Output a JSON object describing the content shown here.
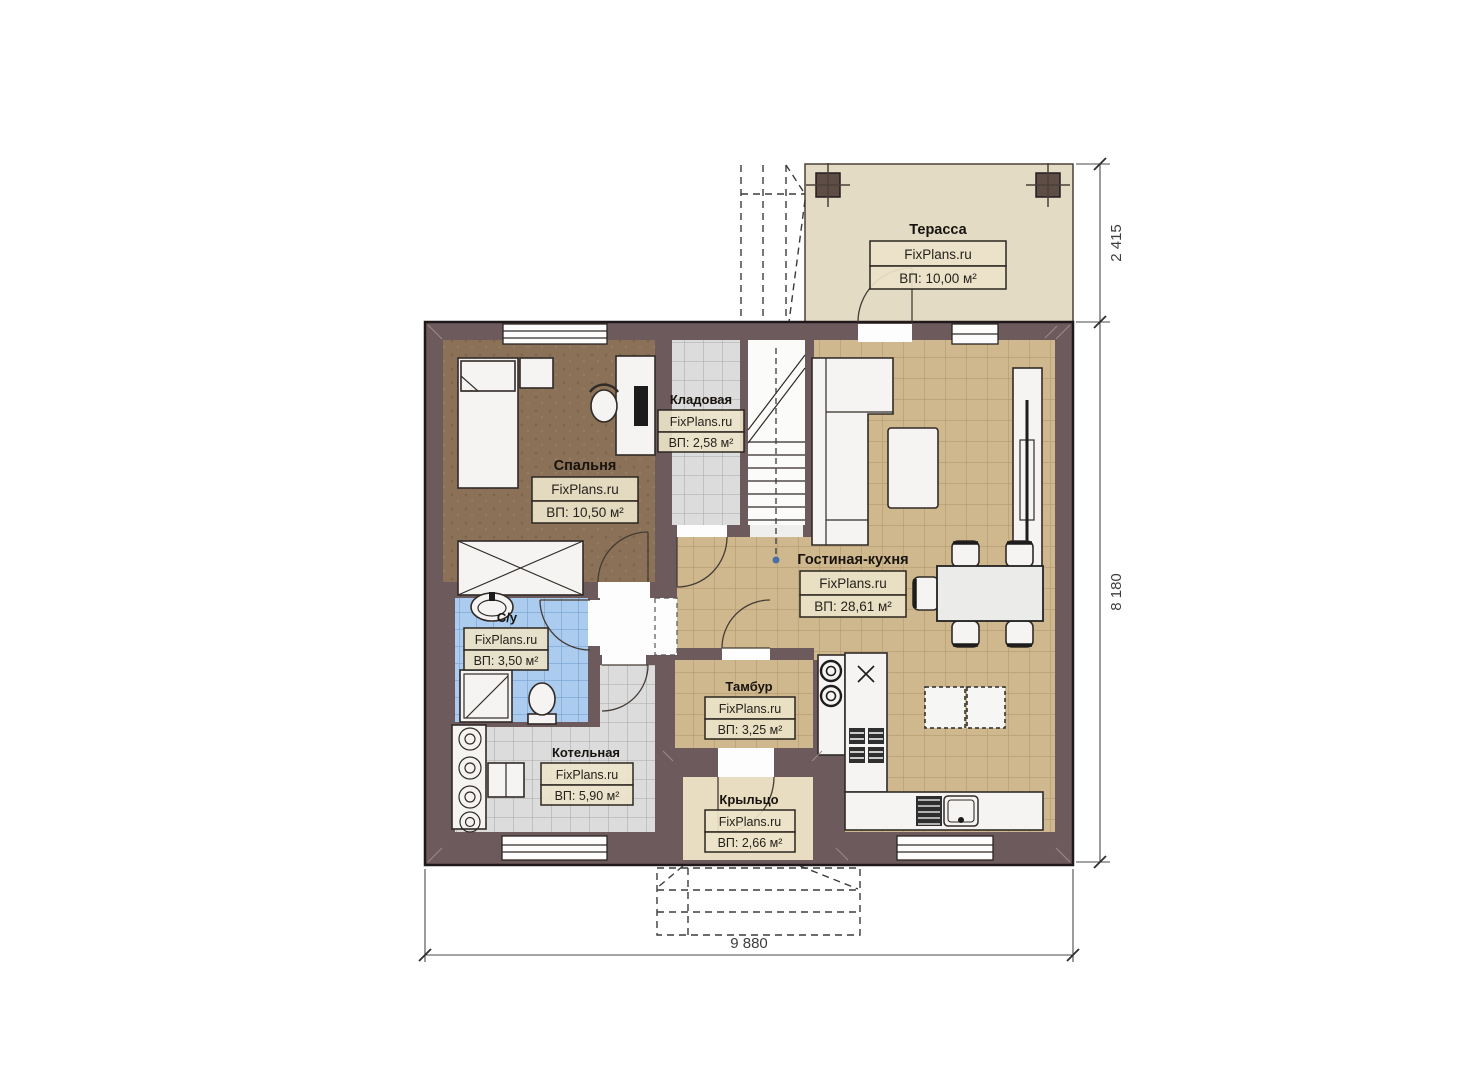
{
  "plan": {
    "brand": "FixPlans.ru",
    "rooms": {
      "terrace": {
        "name": "Терасса",
        "area": "ВП: 10,00 м²"
      },
      "storage": {
        "name": "Кладовая",
        "area": "ВП: 2,58 м²"
      },
      "bedroom": {
        "name": "Спальня",
        "area": "ВП: 10,50 м²"
      },
      "living_kitchen": {
        "name": "Гостиная-кухня",
        "area": "ВП: 28,61 м²"
      },
      "bathroom": {
        "name": "С/у",
        "area": "ВП: 3,50 м²"
      },
      "boiler": {
        "name": "Котельная",
        "area": "ВП: 5,90 м²"
      },
      "vestibule": {
        "name": "Тамбур",
        "area": "ВП: 3,25 м²"
      },
      "porch": {
        "name": "Крыльцо",
        "area": "ВП: 2,66 м²"
      }
    },
    "dimensions": {
      "bottom_width": "9 880",
      "right_height": "8 180",
      "terrace_depth": "2 415"
    },
    "colors": {
      "wall": "#6d5a5c",
      "terrace_floor": "#e4dbc5",
      "porch_floor": "#e8ddc1",
      "bedroom_floor": "#8a7157",
      "label_bg": "#ece3c9"
    }
  }
}
